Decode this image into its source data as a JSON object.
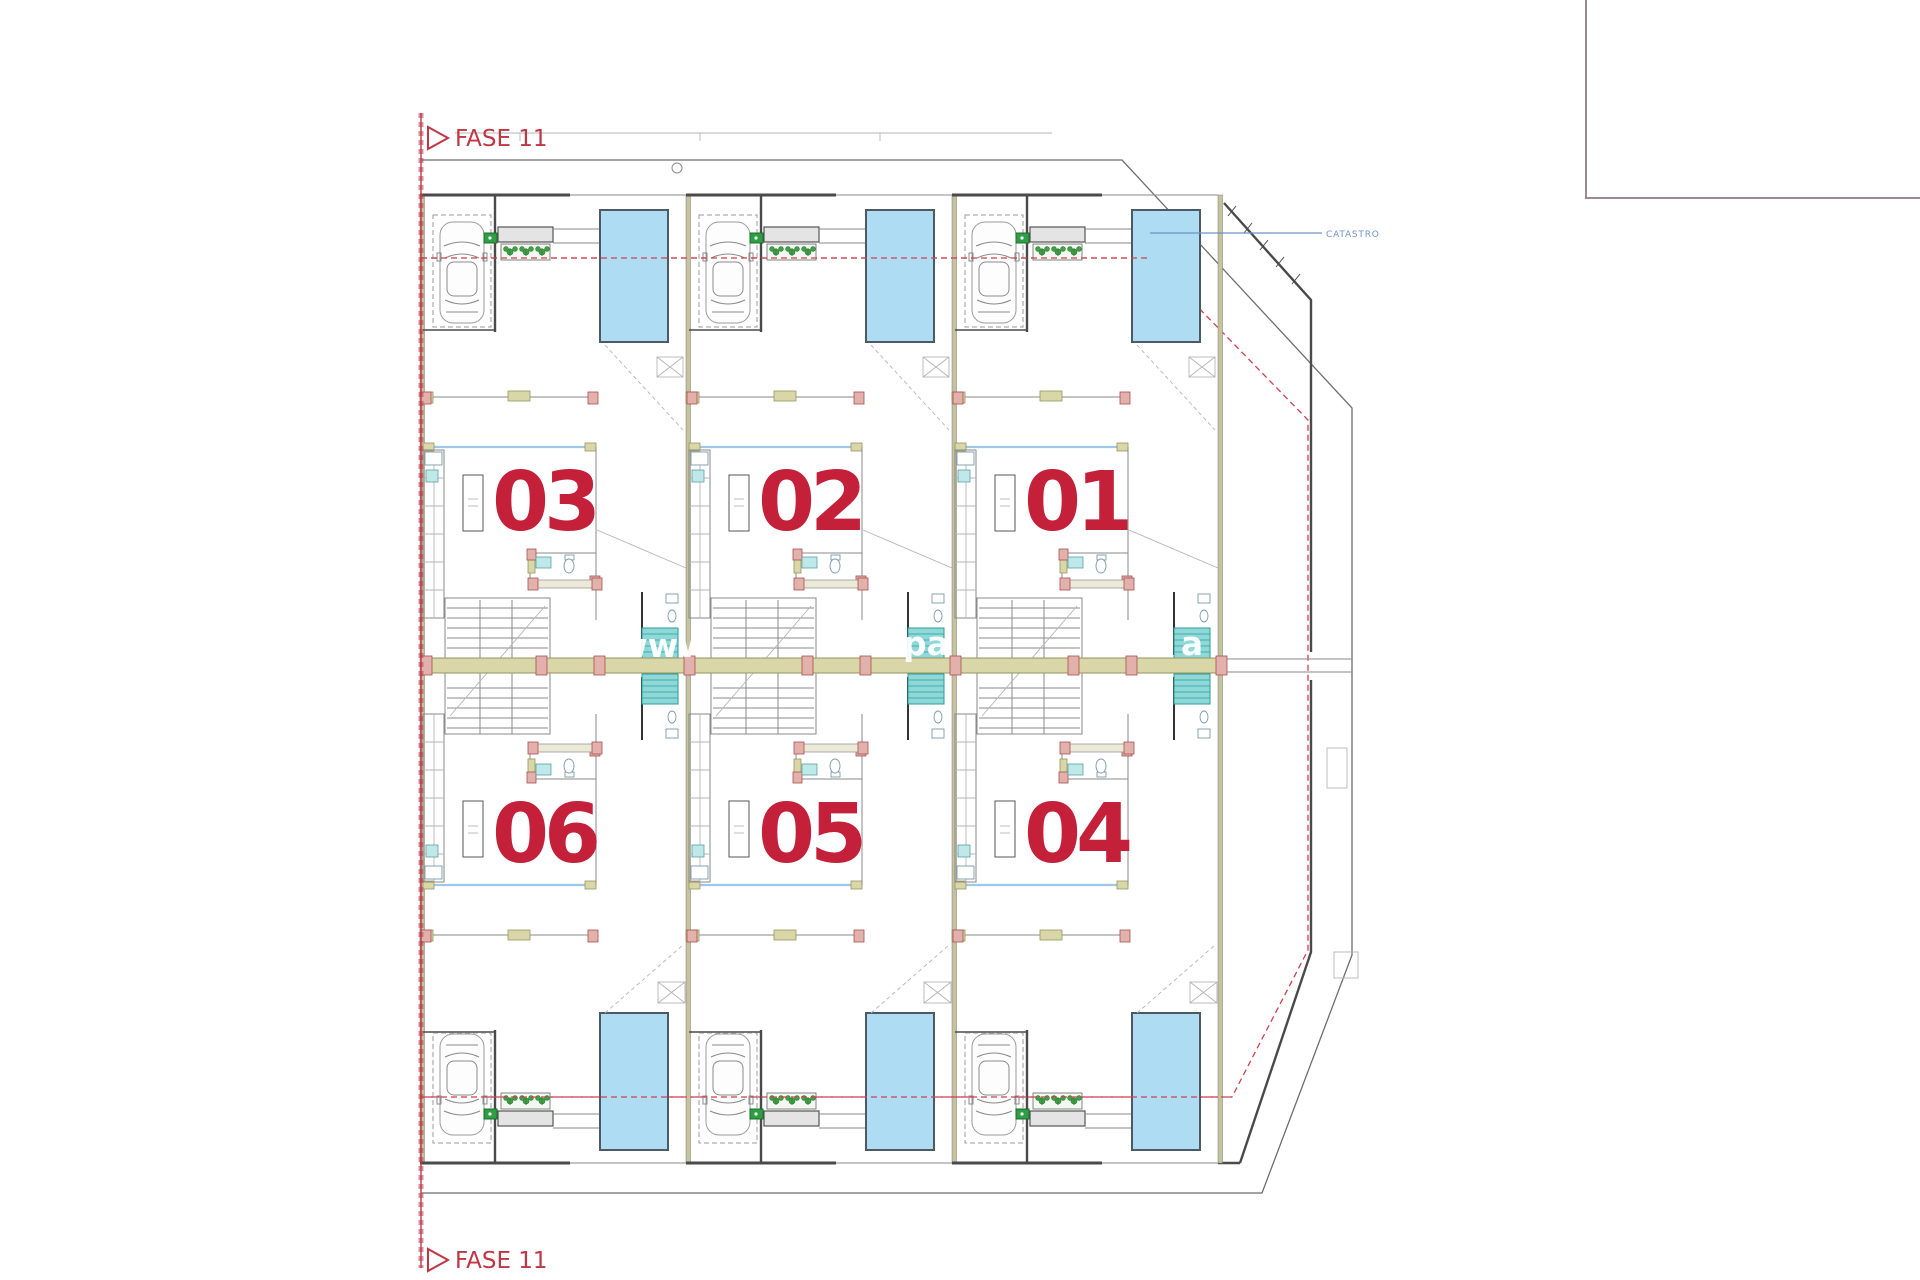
{
  "page": {
    "background": "#ffffff"
  },
  "plan": {
    "phase_labels": {
      "top": "FASE 11",
      "bottom": "FASE 11"
    },
    "catastro_label": "CATASTRO",
    "watermark_fragments": {
      "f1": "www",
      "f2": "pa",
      "f3": "a"
    },
    "units": [
      {
        "label": "03",
        "row": "top",
        "position": "left"
      },
      {
        "label": "02",
        "row": "top",
        "position": "middle"
      },
      {
        "label": "01",
        "row": "top",
        "position": "right"
      },
      {
        "label": "06",
        "row": "bottom",
        "position": "left"
      },
      {
        "label": "05",
        "row": "bottom",
        "position": "middle"
      },
      {
        "label": "04",
        "row": "bottom",
        "position": "right"
      }
    ],
    "colors": {
      "phase_red": "#bf3644",
      "unit_number_red": "#c4203a",
      "pool_fill": "#aedcf2",
      "pool_border": "#4d5a63",
      "shower_teal": "#8fd8d8",
      "wall_olive": "#d9d6a8",
      "column_pink": "#e3b1ac",
      "plant_green": "#3fa047",
      "marker_green": "#2f9e44",
      "catastro_blue": "#6b93c8",
      "boundary_dash_red": "#cf4050",
      "watermark_white": "#ffffff",
      "legend_border": "#9b8a90"
    }
  }
}
